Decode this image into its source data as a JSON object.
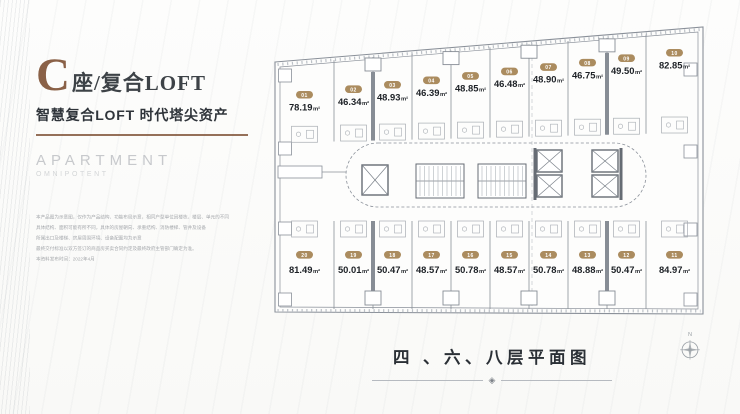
{
  "left_panel": {
    "title_letter": "C",
    "title_rest": "座/复合LOFT",
    "subtitle": "智慧复合LOFT 时代塔尖资产",
    "brand_primary": "APARTMENT",
    "brand_secondary": "OMNIPOTENT",
    "disclaimer_lines": [
      "本产品图为示意图，仅作为产品结构、功能布局示意，相同户型单位因楼栋、楼层、单元的不同",
      "具体结构、面积可能有所不同，具体的房屋朝向、承重结构、消防楼梯、管井及设备",
      "所属出口及楼梯、房屋周围环境、设备配置均为示意",
      "最终交付标准以双方签订的商品房买卖合同约定及最终政府主管部门确定为准。",
      "本资料发布时间：2022年4月"
    ]
  },
  "plan": {
    "caption": "四 、六、八层平面图",
    "compass_label": "N",
    "area_unit": "m²",
    "top_units": [
      {
        "no": "01",
        "area": "78.19"
      },
      {
        "no": "02",
        "area": "46.34"
      },
      {
        "no": "03",
        "area": "48.93"
      },
      {
        "no": "04",
        "area": "46.39"
      },
      {
        "no": "05",
        "area": "48.85"
      },
      {
        "no": "06",
        "area": "46.48"
      },
      {
        "no": "07",
        "area": "48.90"
      },
      {
        "no": "08",
        "area": "46.75"
      },
      {
        "no": "09",
        "area": "49.50"
      },
      {
        "no": "10",
        "area": "82.85"
      }
    ],
    "bottom_units": [
      {
        "no": "20",
        "area": "81.49"
      },
      {
        "no": "19",
        "area": "50.01"
      },
      {
        "no": "18",
        "area": "50.47"
      },
      {
        "no": "17",
        "area": "48.57"
      },
      {
        "no": "16",
        "area": "50.78"
      },
      {
        "no": "15",
        "area": "48.57"
      },
      {
        "no": "14",
        "area": "50.78"
      },
      {
        "no": "13",
        "area": "48.88"
      },
      {
        "no": "12",
        "area": "50.47"
      },
      {
        "no": "11",
        "area": "84.97"
      }
    ]
  },
  "colors": {
    "accent_brown": "#8a6147",
    "badge_gold": "#ab8c5f",
    "area_text": "#1d2126",
    "plan_line": "#8a9099",
    "wall_dark": "#666c74",
    "caption_text": "#2b3036"
  }
}
